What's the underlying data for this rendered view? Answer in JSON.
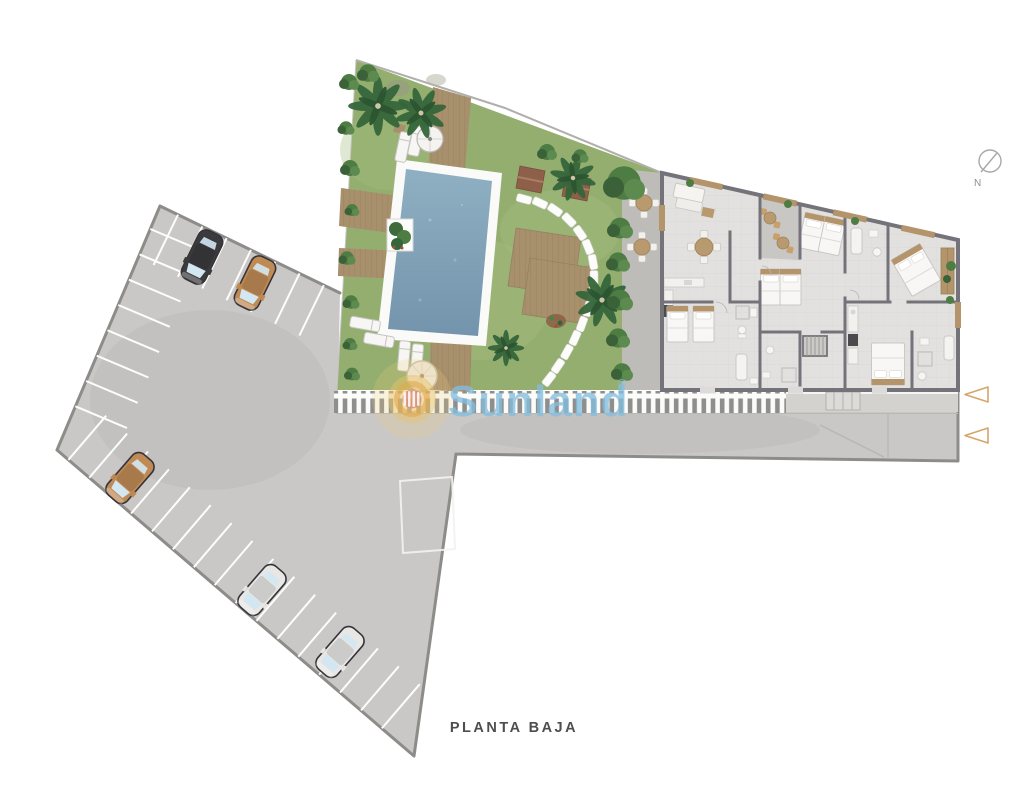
{
  "floor_label": "PLANTA BAJA",
  "compass": {
    "north": "N"
  },
  "watermark": {
    "brand": "Sunland",
    "registered": "®"
  },
  "inventory": {
    "areas": [
      "parking lot",
      "garden",
      "swimming pool",
      "terrace",
      "apartments",
      "road"
    ],
    "parking_cars": [
      {
        "name": "car-black",
        "color": "#3b3a3c"
      },
      {
        "name": "car-tan-1",
        "color": "#c08a55"
      },
      {
        "name": "car-tan-2",
        "color": "#c08a55"
      },
      {
        "name": "car-white-1",
        "color": "#e8e7e5"
      },
      {
        "name": "car-white-2",
        "color": "#e8e7e5"
      }
    ],
    "entrance_markers": {
      "count": 2,
      "pointing": "left",
      "color": "#d4a66a"
    }
  },
  "colors": {
    "background": "#ffffff",
    "pavement": "#c9c8c6",
    "curb": "#8d8c89",
    "lawn": "#94ae70",
    "pool_water": "#7f9fb7",
    "wood_deck": "#a8906c",
    "building_floor": "#e2e1df",
    "building_wall": "#74737a",
    "furniture_tan": "#b4946a",
    "watermark_blue": "#85bedf",
    "logo_gold": "#e3b45f",
    "logo_coral": "#dd8b77",
    "label_text": "#4e4e4e"
  }
}
